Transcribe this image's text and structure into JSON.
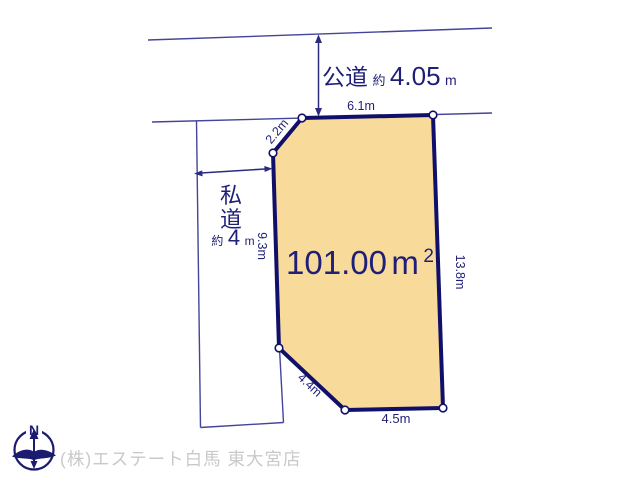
{
  "roads": {
    "public": {
      "label": "公道",
      "approx": "約",
      "value": "4.05",
      "unit": "m"
    },
    "private": {
      "char1": "私",
      "char2": "道",
      "approx": "約",
      "value": "4",
      "unit": "m"
    }
  },
  "plot": {
    "area": {
      "value": "101.00",
      "unit": "m",
      "sup": "2"
    },
    "dims": {
      "top": "6.1m",
      "upper_left": "2.2m",
      "left": "9.3m",
      "right": "13.8m",
      "lower_left": "4.4m",
      "bottom": "4.5m"
    }
  },
  "compass": {
    "north": "N"
  },
  "footer": {
    "company": "(株)エステート白馬 東大宮店"
  },
  "colors": {
    "plot_fill": "#f8db9a",
    "plot_border": "#10106a",
    "thin_line": "#44449a",
    "dimension_text": "#1f1f78",
    "footer_text": "#c9c9c9"
  }
}
